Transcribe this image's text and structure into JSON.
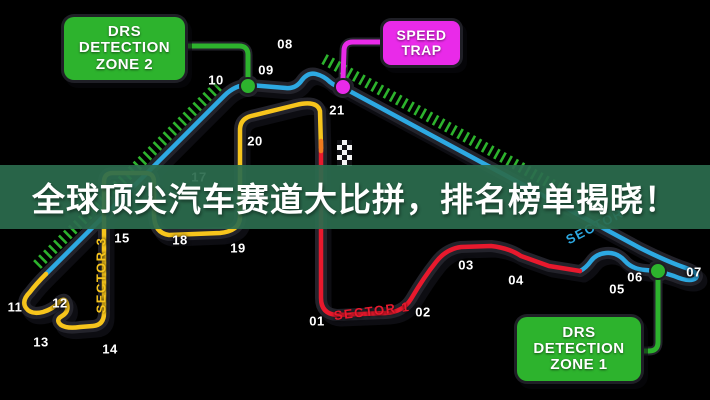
{
  "banner": {
    "text": "全球顶尖汽车赛道大比拼，排名榜单揭晓！"
  },
  "callouts": {
    "drs_zone_2": {
      "line1": "DRS",
      "line2": "DETECTION",
      "line3": "ZONE 2"
    },
    "speed_trap": {
      "line1": "SPEED",
      "line2": "TRAP"
    },
    "drs_zone_1": {
      "line1": "DRS",
      "line2": "DETECTION",
      "line3": "ZONE 1"
    }
  },
  "sector_labels": {
    "sector1": {
      "text": "SECTOR 1"
    },
    "sector2": {
      "text": "SECTOR 2"
    },
    "sector3": {
      "text": "SECTOR 3"
    }
  },
  "turn_labels": [
    {
      "num": "01",
      "x": 317,
      "y": 321
    },
    {
      "num": "02",
      "x": 423,
      "y": 312
    },
    {
      "num": "03",
      "x": 466,
      "y": 265
    },
    {
      "num": "04",
      "x": 516,
      "y": 280
    },
    {
      "num": "05",
      "x": 617,
      "y": 289
    },
    {
      "num": "06",
      "x": 635,
      "y": 277
    },
    {
      "num": "07",
      "x": 694,
      "y": 272
    },
    {
      "num": "08",
      "x": 285,
      "y": 44
    },
    {
      "num": "09",
      "x": 266,
      "y": 70
    },
    {
      "num": "10",
      "x": 216,
      "y": 80
    },
    {
      "num": "11",
      "x": 15,
      "y": 307
    },
    {
      "num": "12",
      "x": 60,
      "y": 303
    },
    {
      "num": "13",
      "x": 41,
      "y": 342
    },
    {
      "num": "14",
      "x": 110,
      "y": 349
    },
    {
      "num": "15",
      "x": 122,
      "y": 238
    },
    {
      "num": "17",
      "x": 199,
      "y": 177
    },
    {
      "num": "18",
      "x": 180,
      "y": 240
    },
    {
      "num": "19",
      "x": 238,
      "y": 248
    },
    {
      "num": "20",
      "x": 255,
      "y": 141
    },
    {
      "num": "21",
      "x": 337,
      "y": 110
    }
  ],
  "colors": {
    "background": "#000000",
    "cyan": "#2da9e2",
    "red": "#e8192d",
    "yellow": "#f7c51c",
    "green": "#2db32d",
    "magenta": "#e92ae9",
    "banner": "#2b6c4d"
  }
}
